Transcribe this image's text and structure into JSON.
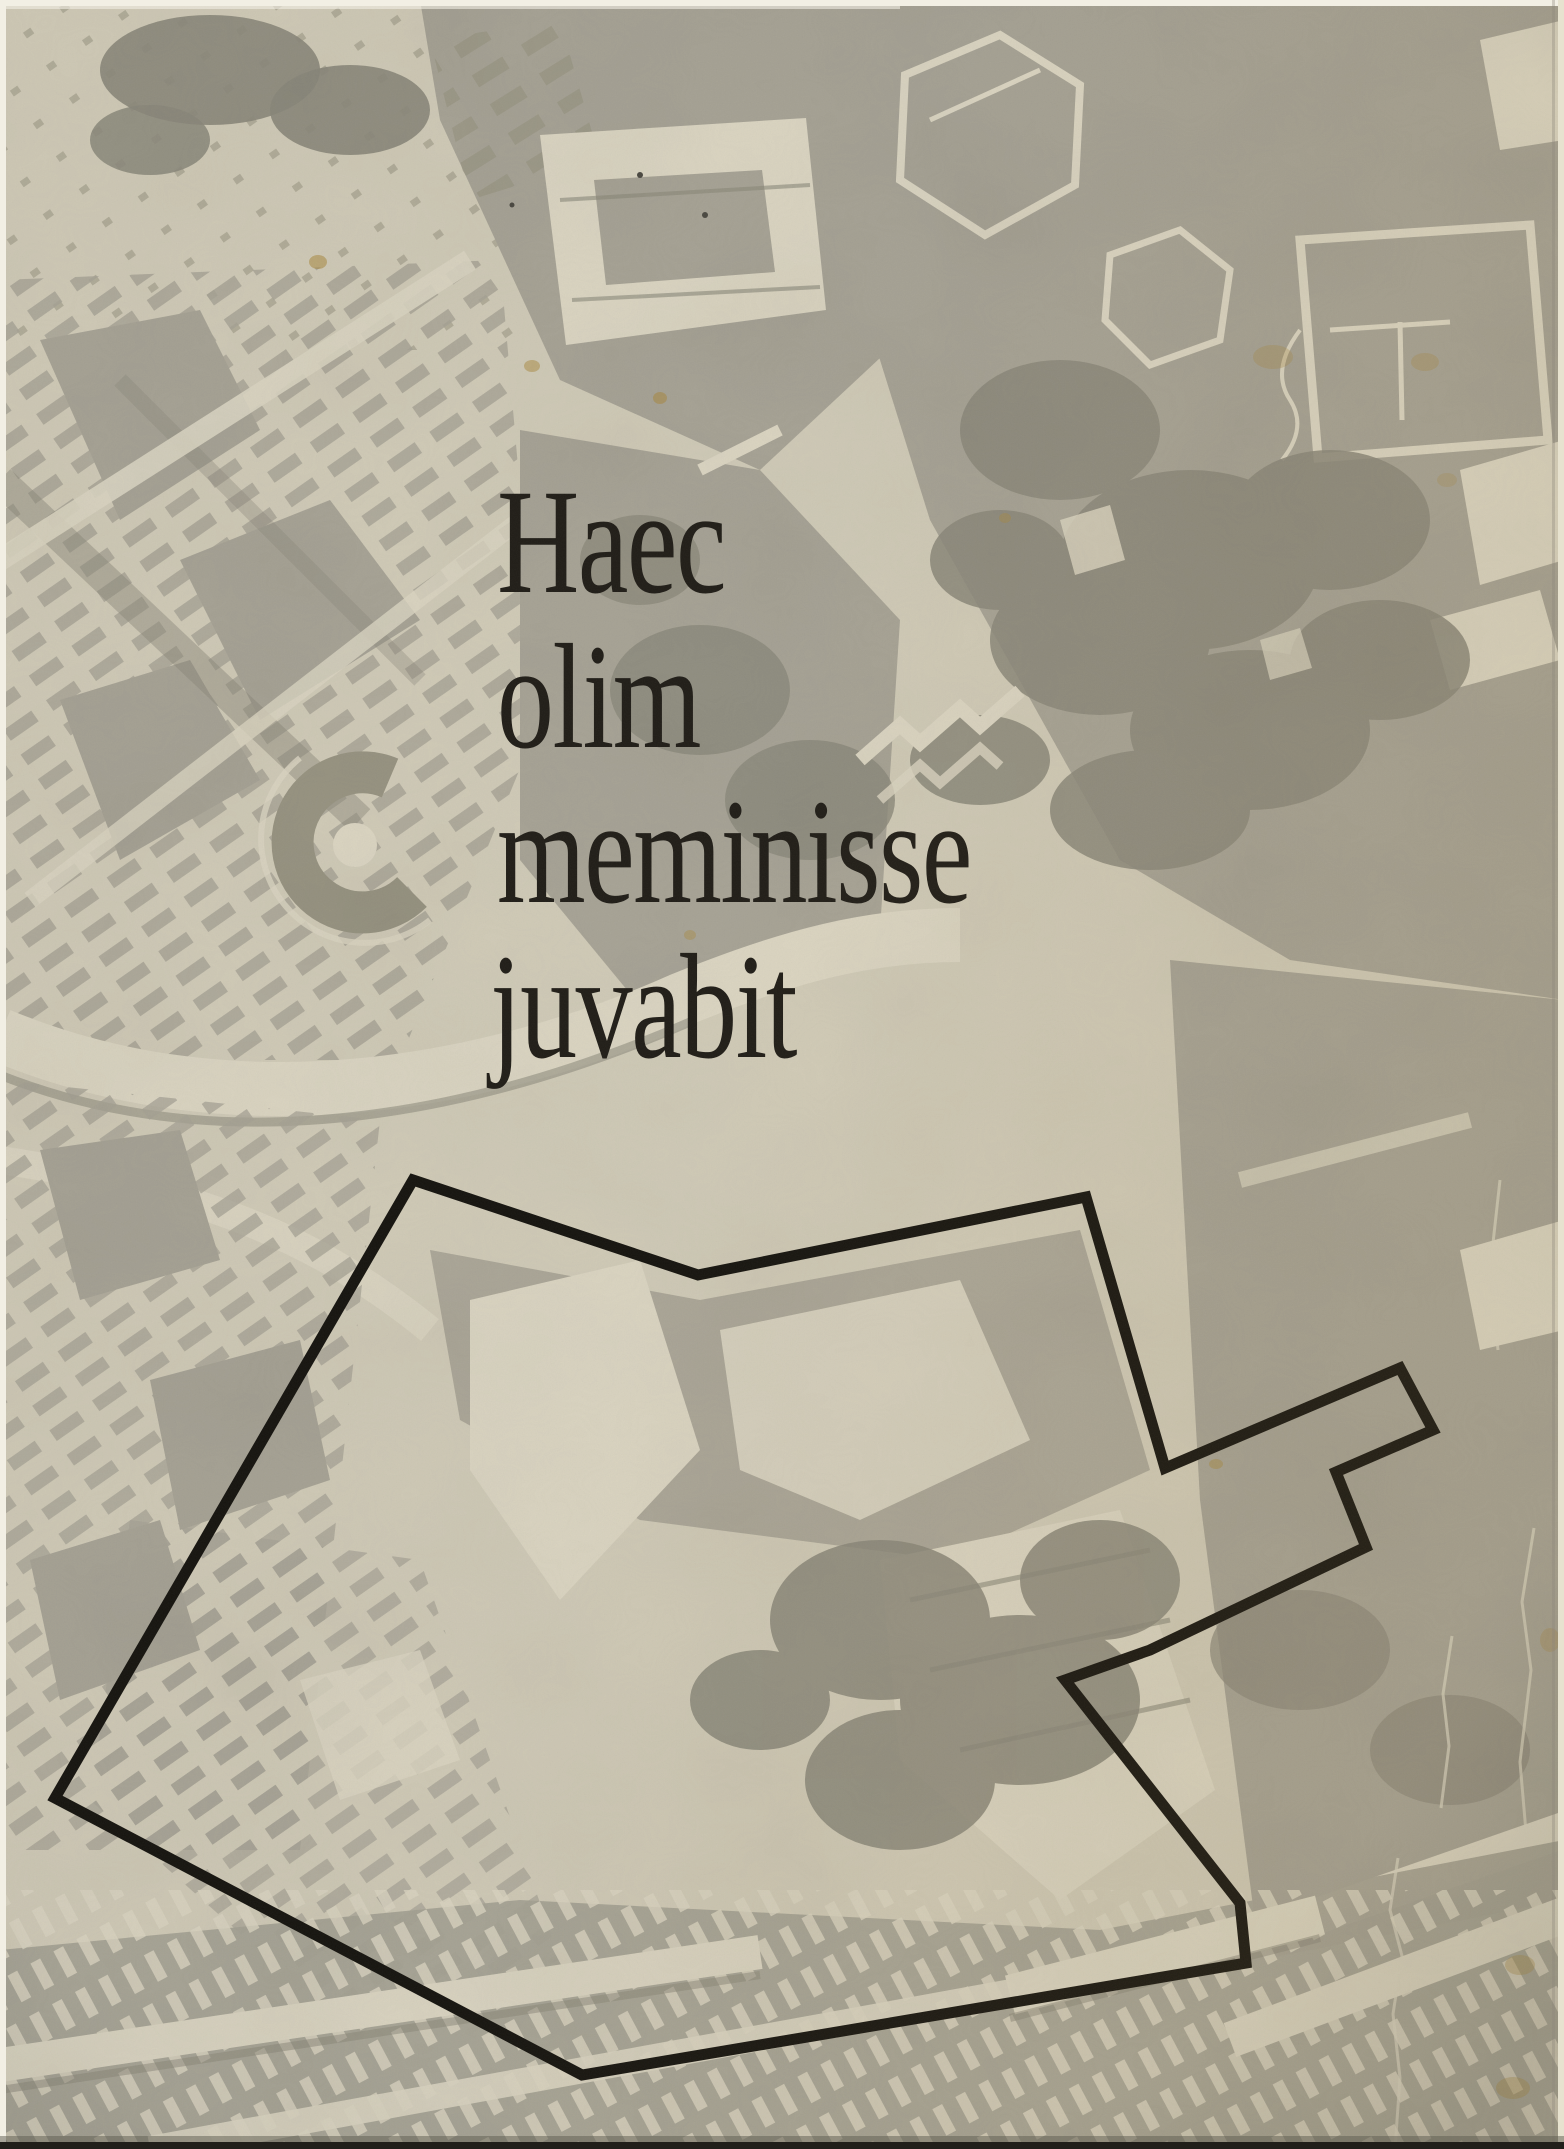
{
  "cover": {
    "title_lines": [
      "Haec",
      "olim",
      "meminisse",
      "juvabit"
    ]
  },
  "boundary": {
    "points": "413,1180 698,1275 1086,1197 1165,1468 1400,1368 1433,1430 1336,1472 1366,1547 1150,1650 1065,1680 1240,1903 1246,1963 582,2075 55,1798",
    "stroke_width": 11
  },
  "colors": {
    "paper_light": "#d2ccb8",
    "photo_bright": "#ddd7c3",
    "photo_mid": "#a7a395",
    "photo_deep": "#979380",
    "photo_dark": "#8b887a",
    "title_ink": "#1f1c16",
    "boundary_ink": "#14120d",
    "scan_white": "#f2efe4",
    "scan_shadow": "#211f1a",
    "stain_amber": "#a9893e"
  }
}
